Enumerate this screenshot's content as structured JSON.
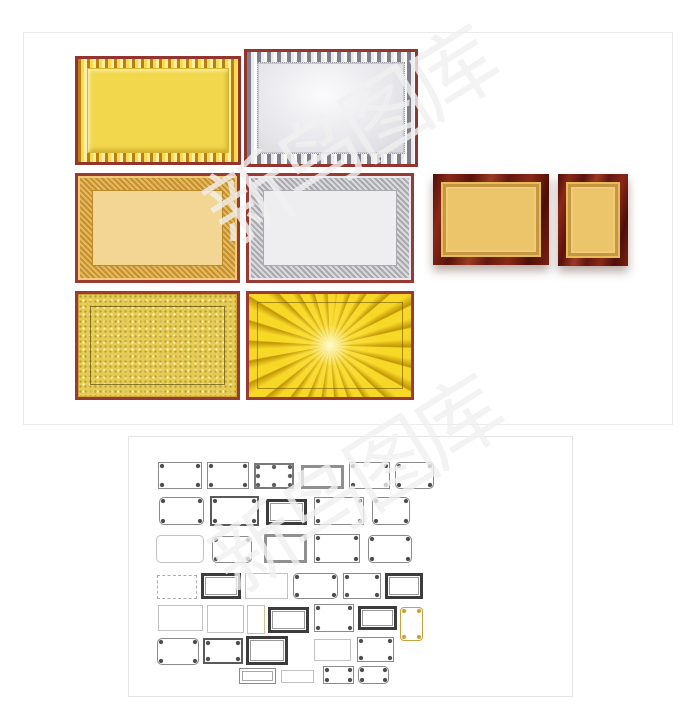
{
  "page": {
    "background": "#ffffff",
    "description_colors": {
      "maroon_frame": "#9a3a33",
      "gold_center": "#f2d74d",
      "silver_center": "#e8e8ec",
      "wood_frame": "#6b1a10",
      "panel_border": "#e9e9e9",
      "watermark_color": "#f1f1f1"
    }
  },
  "watermark": {
    "text": "新鸟图库",
    "lines": [
      {
        "cx": 346,
        "cy": 131
      },
      {
        "cx": 351,
        "cy": 480
      }
    ]
  },
  "top_panel": {
    "frames": [
      {
        "name": "plaque-gold-sunburst",
        "cls": "p-gold-sun",
        "x": 51,
        "y": 23,
        "w": 166,
        "h": 109
      },
      {
        "name": "plaque-silver-sunburst",
        "cls": "p-silver-sun",
        "x": 220,
        "y": 16,
        "w": 174,
        "h": 118
      },
      {
        "name": "plaque-gold-ornate",
        "cls": "p-gold-ornate",
        "x": 51,
        "y": 140,
        "w": 165,
        "h": 110
      },
      {
        "name": "plaque-silver-ornate",
        "cls": "p-silver-ornate",
        "x": 222,
        "y": 140,
        "w": 168,
        "h": 110
      },
      {
        "name": "plaque-wood-gold-landscape",
        "cls": "p-wood",
        "x": 409,
        "y": 141,
        "w": 116,
        "h": 91
      },
      {
        "name": "plaque-wood-gold-portrait",
        "cls": "p-wood",
        "x": 534,
        "y": 141,
        "w": 70,
        "h": 92
      },
      {
        "name": "plaque-gold-speckled",
        "cls": "p-gold-speckle",
        "x": 51,
        "y": 258,
        "w": 165,
        "h": 109
      },
      {
        "name": "plaque-gold-radial",
        "cls": "p-gold-radial",
        "x": 222,
        "y": 258,
        "w": 168,
        "h": 109
      }
    ]
  },
  "bottom_panel": {
    "frames": [
      {
        "name": "border-frame-1",
        "cls": "f-cornered",
        "x": 29,
        "y": 25,
        "w": 44,
        "h": 27
      },
      {
        "name": "border-frame-2",
        "cls": "f-cornered",
        "x": 78,
        "y": 25,
        "w": 42,
        "h": 27
      },
      {
        "name": "border-frame-3",
        "cls": "f-dots",
        "x": 125,
        "y": 26,
        "w": 40,
        "h": 26
      },
      {
        "name": "border-frame-4",
        "cls": "f-thick",
        "x": 172,
        "y": 28,
        "w": 43,
        "h": 24
      },
      {
        "name": "border-frame-5",
        "cls": "f-cornered",
        "x": 220,
        "y": 25,
        "w": 41,
        "h": 27
      },
      {
        "name": "border-frame-6",
        "cls": "f-cornered-round",
        "x": 266,
        "y": 25,
        "w": 39,
        "h": 27
      },
      {
        "name": "border-frame-7",
        "cls": "f-cornered-round",
        "x": 30,
        "y": 60,
        "w": 45,
        "h": 28
      },
      {
        "name": "border-frame-8",
        "cls": "f-heavy",
        "x": 81,
        "y": 59,
        "w": 49,
        "h": 30
      },
      {
        "name": "border-frame-9",
        "cls": "f-dark",
        "x": 137,
        "y": 62,
        "w": 41,
        "h": 26
      },
      {
        "name": "border-frame-10",
        "cls": "f-cornered",
        "x": 185,
        "y": 60,
        "w": 50,
        "h": 28
      },
      {
        "name": "border-frame-11",
        "cls": "f-cornered-round",
        "x": 243,
        "y": 60,
        "w": 38,
        "h": 28
      },
      {
        "name": "border-frame-12",
        "cls": "f-light-round",
        "x": 27,
        "y": 98,
        "w": 48,
        "h": 28
      },
      {
        "name": "border-frame-13",
        "cls": "f-cornered-round",
        "x": 83,
        "y": 99,
        "w": 40,
        "h": 27
      },
      {
        "name": "border-frame-14",
        "cls": "f-thick",
        "x": 135,
        "y": 97,
        "w": 43,
        "h": 29
      },
      {
        "name": "border-frame-15",
        "cls": "f-cornered",
        "x": 185,
        "y": 97,
        "w": 46,
        "h": 29
      },
      {
        "name": "border-frame-16",
        "cls": "f-cornered-round",
        "x": 239,
        "y": 98,
        "w": 44,
        "h": 28
      },
      {
        "name": "border-frame-17",
        "cls": "f-dashed",
        "x": 28,
        "y": 138,
        "w": 40,
        "h": 24
      },
      {
        "name": "border-frame-18",
        "cls": "f-dark",
        "x": 72,
        "y": 136,
        "w": 40,
        "h": 26
      },
      {
        "name": "border-frame-19",
        "cls": "f-light",
        "x": 116,
        "y": 136,
        "w": 43,
        "h": 26
      },
      {
        "name": "border-frame-20",
        "cls": "f-cornered-round",
        "x": 164,
        "y": 136,
        "w": 45,
        "h": 26
      },
      {
        "name": "border-frame-21",
        "cls": "f-cornered",
        "x": 214,
        "y": 136,
        "w": 38,
        "h": 26
      },
      {
        "name": "border-frame-22",
        "cls": "f-dark",
        "x": 256,
        "y": 136,
        "w": 38,
        "h": 26
      },
      {
        "name": "border-frame-23",
        "cls": "f-light",
        "x": 29,
        "y": 168,
        "w": 45,
        "h": 26
      },
      {
        "name": "border-frame-24",
        "cls": "f-light",
        "x": 78,
        "y": 168,
        "w": 37,
        "h": 28
      },
      {
        "name": "border-frame-25",
        "cls": "f-tan",
        "x": 118,
        "y": 168,
        "w": 18,
        "h": 29
      },
      {
        "name": "border-frame-26",
        "cls": "f-dark",
        "x": 139,
        "y": 170,
        "w": 41,
        "h": 26
      },
      {
        "name": "border-frame-27",
        "cls": "f-cornered",
        "x": 185,
        "y": 167,
        "w": 40,
        "h": 28
      },
      {
        "name": "border-frame-28",
        "cls": "f-dark",
        "x": 229,
        "y": 169,
        "w": 39,
        "h": 24
      },
      {
        "name": "border-frame-29",
        "cls": "f-gold",
        "x": 271,
        "y": 170,
        "w": 23,
        "h": 34
      },
      {
        "name": "border-frame-30",
        "cls": "f-cornered-round",
        "x": 28,
        "y": 201,
        "w": 42,
        "h": 27
      },
      {
        "name": "border-frame-31",
        "cls": "f-heavy",
        "x": 74,
        "y": 201,
        "w": 40,
        "h": 26
      },
      {
        "name": "border-frame-32",
        "cls": "f-dark",
        "x": 117,
        "y": 199,
        "w": 42,
        "h": 29
      },
      {
        "name": "border-frame-33",
        "cls": "f-light",
        "x": 185,
        "y": 202,
        "w": 37,
        "h": 22
      },
      {
        "name": "border-frame-34",
        "cls": "f-cornered",
        "x": 228,
        "y": 200,
        "w": 37,
        "h": 25
      },
      {
        "name": "border-frame-35",
        "cls": "f-double",
        "x": 110,
        "y": 231,
        "w": 37,
        "h": 16
      },
      {
        "name": "border-frame-36",
        "cls": "f-light",
        "x": 152,
        "y": 233,
        "w": 33,
        "h": 13
      },
      {
        "name": "border-frame-37",
        "cls": "f-cornered",
        "x": 194,
        "y": 229,
        "w": 31,
        "h": 18
      },
      {
        "name": "border-frame-38",
        "cls": "f-cornered-round",
        "x": 229,
        "y": 229,
        "w": 31,
        "h": 18
      }
    ]
  }
}
